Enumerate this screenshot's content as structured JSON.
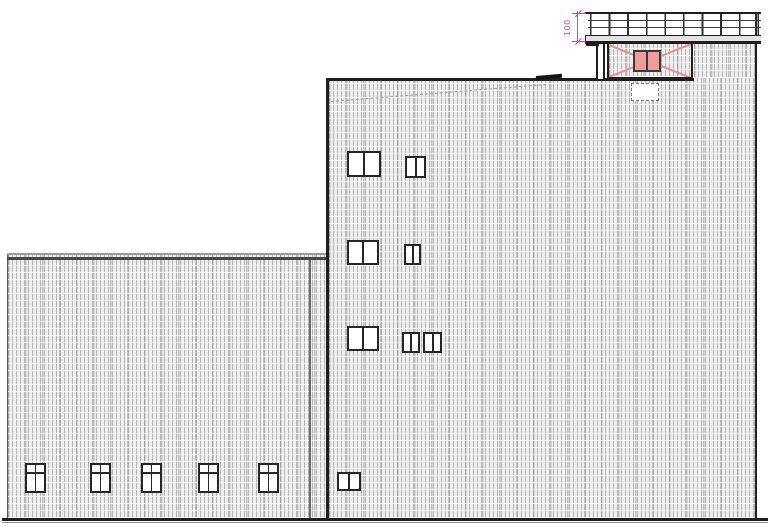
{
  "drawing": {
    "type": "architectural-elevation",
    "annotations": {
      "dimension": {
        "label": "100",
        "color": "#c840c8"
      }
    },
    "colors": {
      "wall_hatch_background": "#ededed",
      "wall_hatch_line": "#c2c2c2",
      "outline": "#1e1e1e",
      "penthouse_cross_line": "#e88f8f",
      "machine_unit_fill": "#f19c9c",
      "dimension_magenta": "#c840c8"
    },
    "counts": {
      "left_building_windows": 5,
      "tall_building_windows": 8,
      "railing_horizontal_rails": 3
    }
  }
}
